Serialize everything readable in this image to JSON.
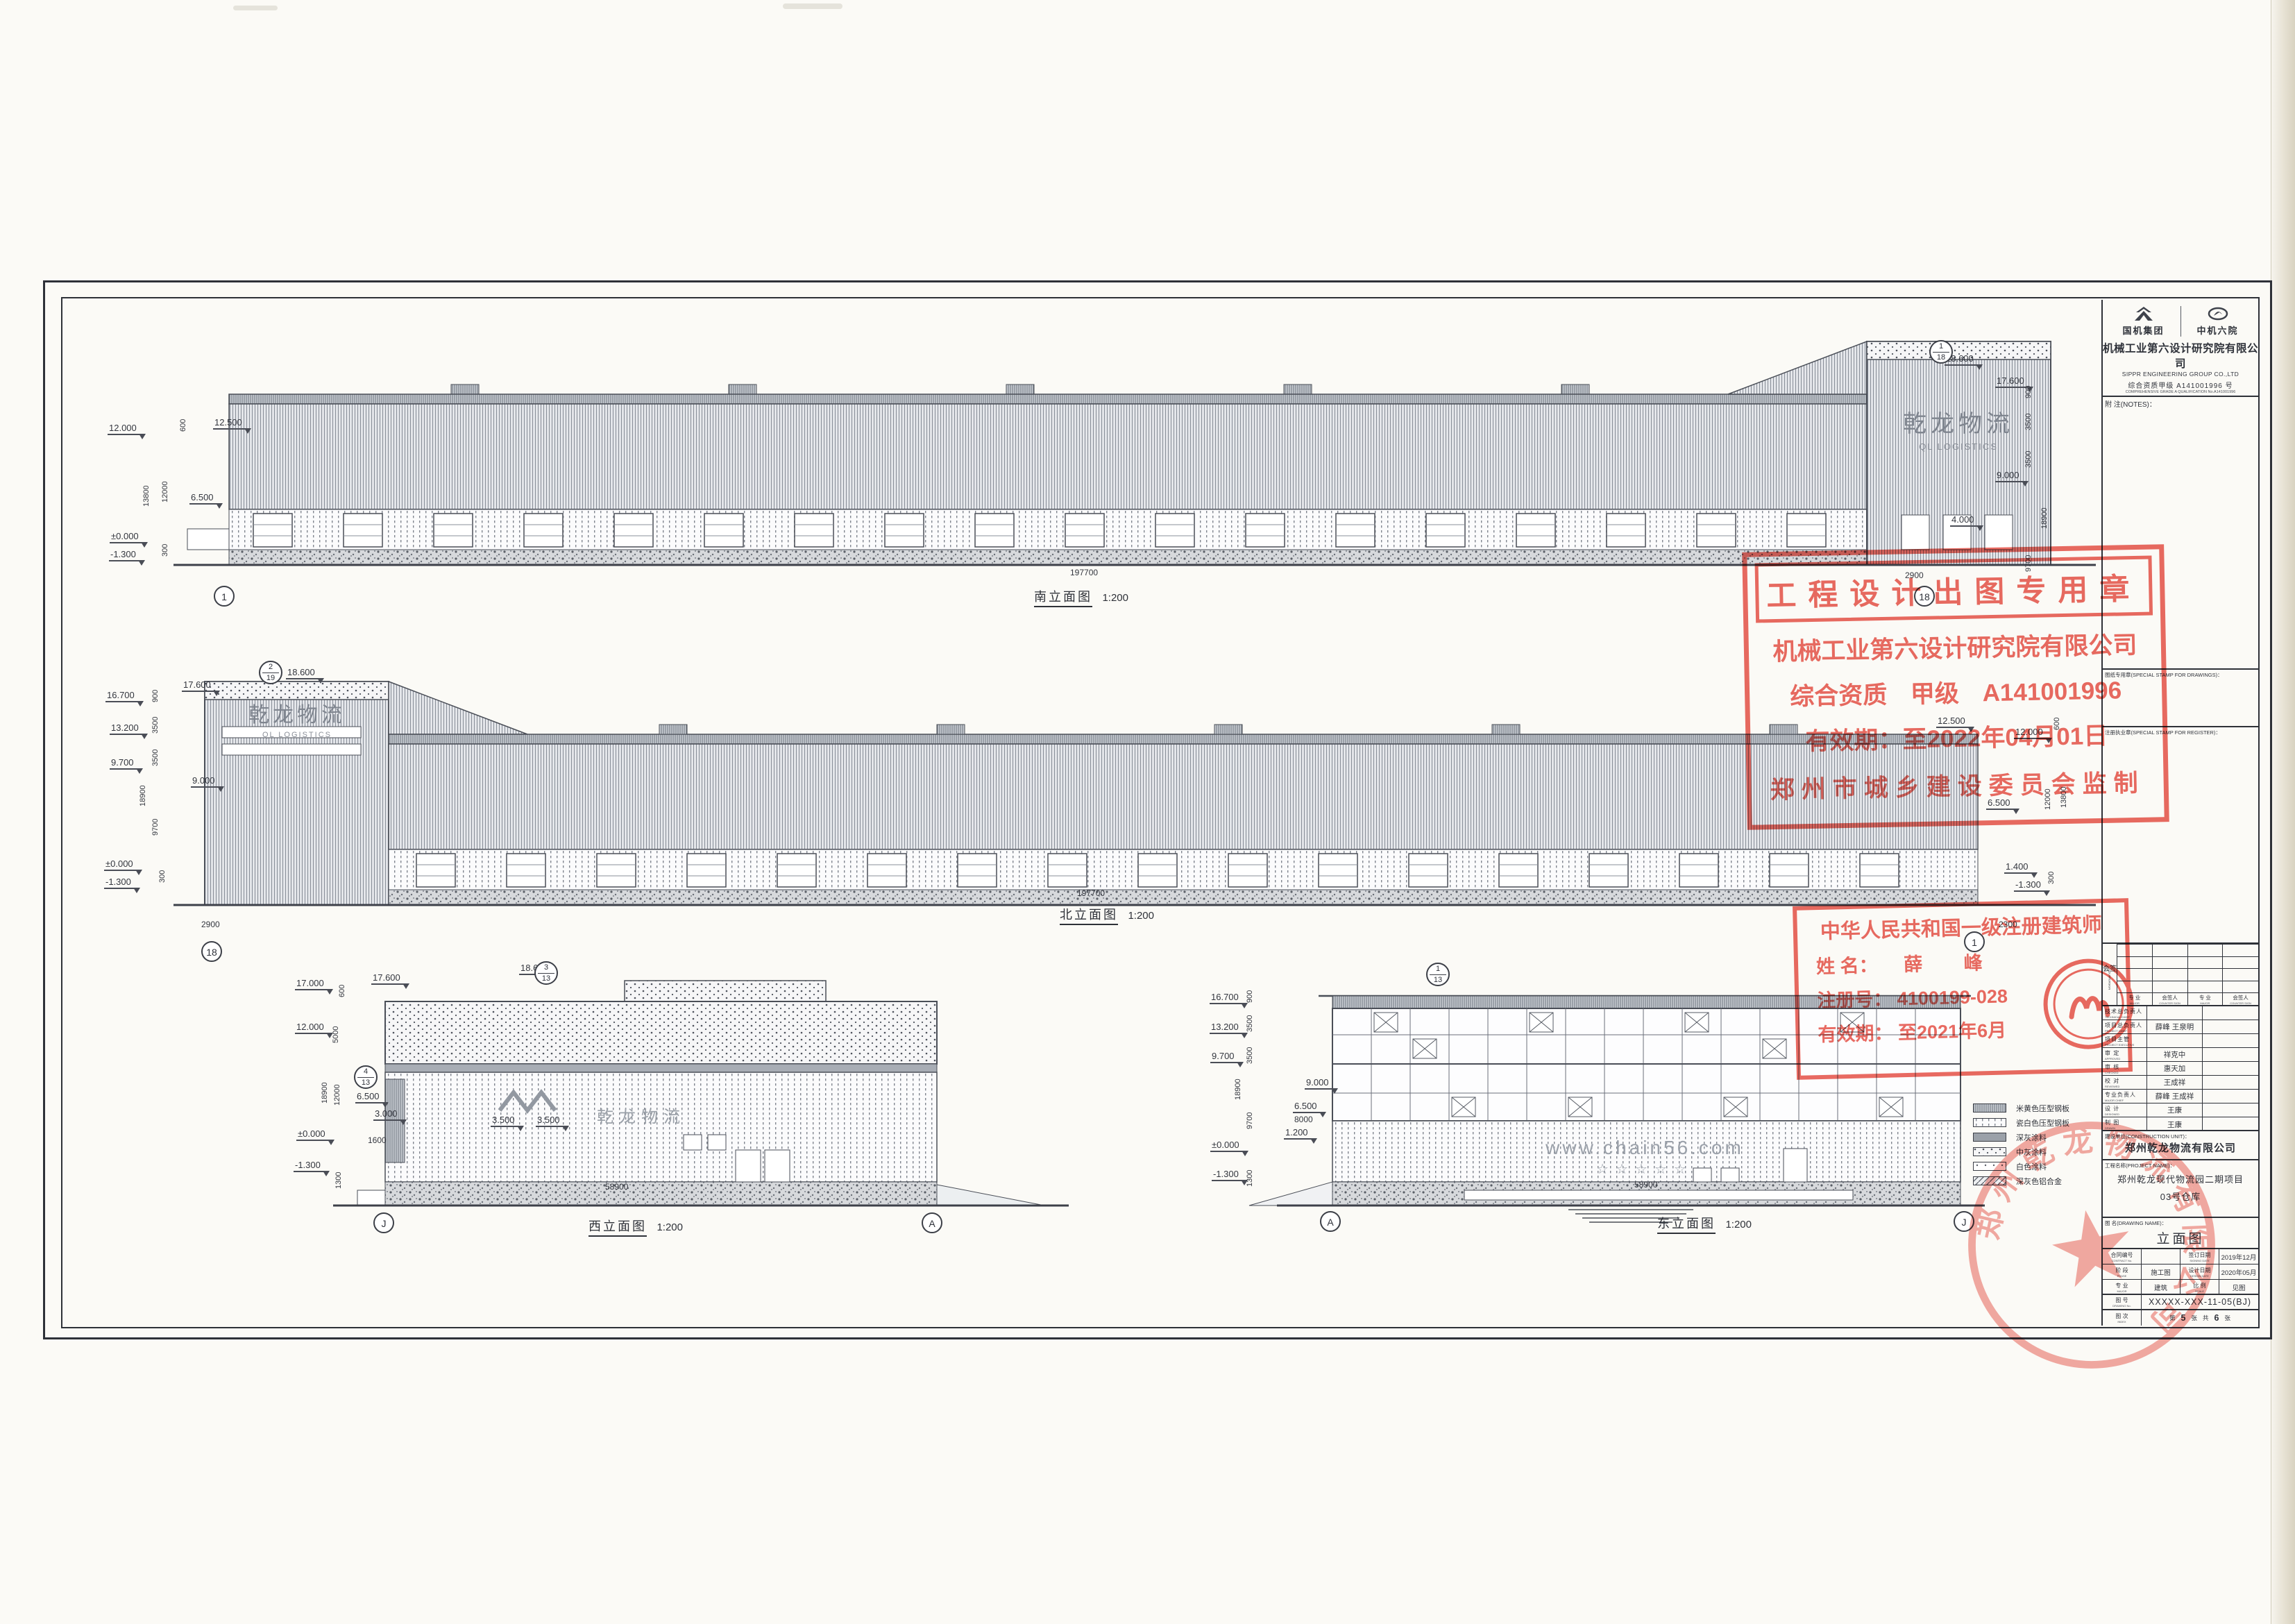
{
  "elev": {
    "south": {
      "label": "南立面图",
      "scale": "1:200",
      "levels": [
        "12.000",
        "12.500",
        "6.500",
        "±0.000",
        "-1.300",
        "18.600",
        "17.600",
        "9.000",
        "4.000"
      ],
      "dims": [
        "600",
        "13800",
        "12000",
        "300",
        "900",
        "3500",
        "3500",
        "18900",
        "9700"
      ],
      "hdims": [
        "2900",
        "197700"
      ],
      "grid_left": "1",
      "grid_right": "18",
      "ref": {
        "top": "1",
        "bot": "18"
      },
      "logo_cn": "乾龙物流",
      "logo_en": "QL LOGISTICS"
    },
    "north": {
      "label": "北立面图",
      "scale": "1:200",
      "levels": [
        "16.700",
        "13.200",
        "9.700",
        "±0.000",
        "-1.300",
        "17.600",
        "18.600",
        "9.000",
        "12.500",
        "12.000",
        "6.500",
        "1.400",
        "-1.300"
      ],
      "dims": [
        "900",
        "3500",
        "3500",
        "18900",
        "9700",
        "300",
        "600",
        "12000",
        "13800",
        "300"
      ],
      "hdims": [
        "2900",
        "2300",
        "197700"
      ],
      "grid_left": "18",
      "grid_right": "1",
      "ref": {
        "top": "2",
        "bot": "19"
      },
      "logo_cn": "乾龙物流",
      "logo_en": "QL LOGISTICS"
    },
    "west": {
      "label": "西立面图",
      "scale": "1:200",
      "levels": [
        "17.000",
        "12.000",
        "±0.000",
        "-1.300",
        "17.600",
        "18.600",
        "6.500",
        "3.000",
        "3.500",
        "3.500"
      ],
      "dims": [
        "600",
        "5000",
        "18900",
        "12000",
        "1300"
      ],
      "hdims": [
        "1600",
        "58900"
      ],
      "grid_left": "J",
      "grid_right": "A",
      "ref": {
        "top": "3",
        "bot": "13"
      },
      "ref2": {
        "top": "4",
        "bot": "13"
      },
      "wall_text": "乾龙物流"
    },
    "east": {
      "label": "东立面图",
      "scale": "1:200",
      "levels": [
        "16.700",
        "13.200",
        "9.700",
        "±0.000",
        "-1.300",
        "9.000",
        "6.500",
        "1.200"
      ],
      "dims": [
        "900",
        "3500",
        "3500",
        "18900",
        "9700",
        "1300"
      ],
      "hdims": [
        "8000",
        "58900"
      ],
      "grid_left": "A",
      "grid_right": "J",
      "ref": {
        "top": "1",
        "bot": "13"
      },
      "wall_text": "www.chain56.com",
      "stars": "☆☆☆☆☆"
    }
  },
  "legend": {
    "items": [
      {
        "label": "米黄色压型钢板"
      },
      {
        "label": "瓷白色压型钢板"
      },
      {
        "label": "深灰涂料"
      },
      {
        "label": "中灰涂料"
      },
      {
        "label": "白色涂料"
      },
      {
        "label": "深灰色铝合金"
      }
    ]
  },
  "title_block": {
    "logos": {
      "left": "国机集团",
      "right": "中机六院"
    },
    "company_cn": "机械工业第六设计研究院有限公司",
    "company_en": "SIPPR ENGINEERING GROUP CO.,LTD",
    "qualification_cn": "综合资质甲级 A141001996 号",
    "qualification_en": "COMPREHENSIVE GRADE A QUALIFICATION No.A141001996",
    "website": "HTTP://WWW.SIPPR.CN",
    "notes_label": "附 注(NOTES)：",
    "drawings_stamp_label": "图纸专用章(SPECIAL STAMP FOR DRAWINGS)：",
    "register_stamp_label": "注册执业章(SPECIAL STAMP FOR REGISTER)：",
    "countersign": {
      "label": "会签",
      "label_en": "COUNTERSIGN",
      "headers": [
        {
          "cn": "专 业",
          "en": "MAJOR"
        },
        {
          "cn": "会签人",
          "en": "COUNTER SIGN"
        },
        {
          "cn": "专 业",
          "en": "MAJOR"
        },
        {
          "cn": "会签人",
          "en": "COUNTER SIGN"
        }
      ]
    },
    "personnel": [
      {
        "cn": "技术总负责人",
        "en": "TECHNICAL CHIEF",
        "name": ""
      },
      {
        "cn": "项目总负责人",
        "en": "PROJECT CHIEF",
        "name": "薛峰 王泉明"
      },
      {
        "cn": "项目主管",
        "en": "PROJECT EXECUTIVE",
        "name": ""
      },
      {
        "cn": "审 定",
        "en": "APPROVED",
        "name": "祥克中"
      },
      {
        "cn": "审 核",
        "en": "CHECKED",
        "name": "惠天加"
      },
      {
        "cn": "校 对",
        "en": "REVIEWED",
        "name": "王成祥"
      },
      {
        "cn": "专业负责人",
        "en": "MAJOR CHIEF",
        "name": "薛峰 王成祥"
      },
      {
        "cn": "设 计",
        "en": "DESIGNED",
        "name": "王康"
      },
      {
        "cn": "制 图",
        "en": "DRAWN",
        "name": "王康"
      }
    ],
    "construction_unit": {
      "label": "建设单位(CONSTRUCTION UNIT)：",
      "value": "郑州乾龙物流有限公司"
    },
    "project": {
      "label": "工程名称(PROJECT NAME)：",
      "line1": "郑州乾龙现代物流园二期项目",
      "line2": "03号仓库"
    },
    "drawing_name": {
      "label": "图 名(DRAWING NAME)：",
      "value": "立面图"
    },
    "meta": {
      "contract_label": "合同编号",
      "contract_label_en": "CONTRACT No.",
      "contract_value": "",
      "sign_date_label": "签订日期",
      "sign_date_label_en": "SIGNING DATE",
      "sign_date": "2019年12月",
      "phase_label": "阶 段",
      "phase_label_en": "PHASE",
      "phase": "施工图",
      "design_date_label": "设计日期",
      "design_date_label_en": "DESIGN DATE",
      "design_date": "2020年05月",
      "major_label": "专 业",
      "major_label_en": "MAJOR",
      "major": "建筑",
      "scale_label": "比 例",
      "scale_label_en": "SCALE",
      "scale": "见图"
    },
    "drawing_no": {
      "label": "图 号",
      "label_en": "DRAWING No.",
      "value": "XXXXX-XXX-11-05(BJ)"
    },
    "index": {
      "label": "图 次",
      "label_en": "INDEX",
      "pre": "第",
      "no": "5",
      "unit1": "张",
      "mid": "共",
      "total": "6",
      "unit2": "张"
    }
  },
  "stamps": {
    "design": {
      "title": "工程设计出图专用章",
      "company": "机械工业第六设计研究院有限公司",
      "qual_label": "综合资质",
      "qual_grade": "甲级",
      "qual_no": "A141001996",
      "validity": "有效期：至2022年04月01日",
      "issuer": "郑州市城乡建设委员会监制"
    },
    "architect": {
      "title": "中华人民共和国一级注册建筑师",
      "name_label": "姓 名：",
      "name": "薛 峰",
      "reg_label": "注册号：",
      "reg_no": "4100199-028",
      "valid_label": "有效期：",
      "validity": "至2021年6月"
    },
    "company_seal": {
      "text": "郑州乾龙物流有限公司"
    }
  }
}
